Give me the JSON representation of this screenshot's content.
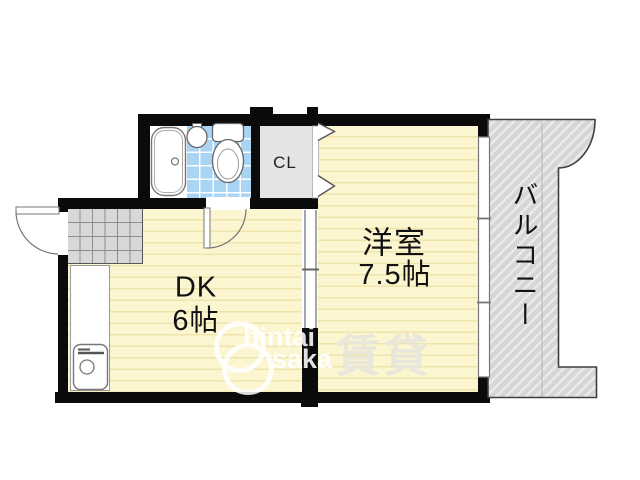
{
  "plan": {
    "type": "japanese-apartment-floor-plan",
    "rooms": [
      {
        "id": "dk",
        "label": "DK",
        "size": "6帖"
      },
      {
        "id": "western",
        "label": "洋室",
        "size": "7.5帖"
      },
      {
        "id": "closet",
        "label": "CL"
      },
      {
        "id": "balcony",
        "label": "バルコニー"
      }
    ],
    "fixtures": [
      "bathtub-icon",
      "wash-basin-icon",
      "toilet-icon",
      "kitchen-sink-icon",
      "entrance-door-swing",
      "bathroom-door-swing",
      "sliding-door",
      "closet-folding-door-icon",
      "window-icon",
      "genkan-tile-area"
    ]
  },
  "watermark": {
    "line1": "hintai",
    "line2": "saka",
    "brand": "賃貸"
  },
  "colors": {
    "wall": "#0b0b0b",
    "floor": "#FBF5D0",
    "floor_stripe": "#EFE5AC",
    "bath_tile": "#A9D4F3",
    "closet_fill": "#E6E3E7",
    "genkan_fill": "#D8D8D8",
    "balcony_fill": "#D6D6D6"
  }
}
